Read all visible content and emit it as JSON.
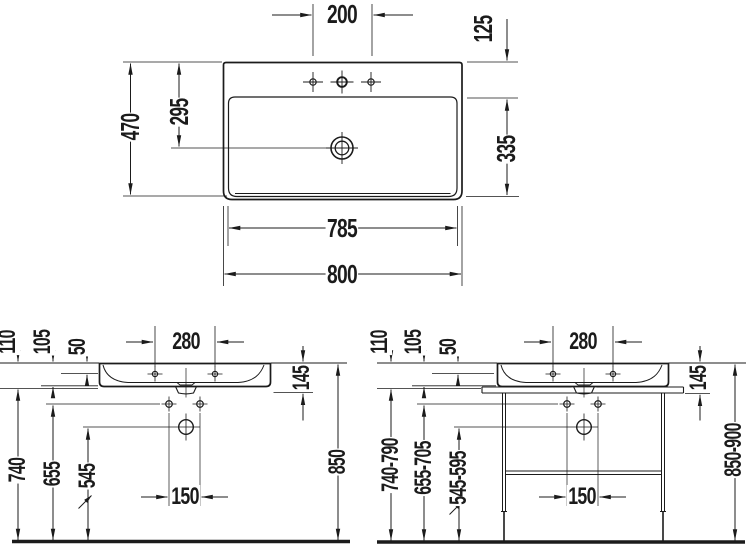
{
  "colors": {
    "line": "#1b1b1b",
    "background": "#ffffff"
  },
  "views": {
    "plan": {
      "faucet_hole_spacing": "200",
      "rear_ledge_depth": "125",
      "overall_depth": "470",
      "rear_to_drain": "295",
      "bowl_depth": "335",
      "lower_width": "785",
      "overall_width": "800"
    },
    "front_wall_mounted": {
      "deck_hole_spacing": "280",
      "rim_to_line_a": "110",
      "rim_to_line_b": "105",
      "rim_to_line_c": "50",
      "basin_height": "145",
      "rim_height": "850",
      "underside_height": "740",
      "fixing_holes_height": "655",
      "drain_height": "545",
      "fixing_hole_spacing": "150"
    },
    "front_with_console": {
      "deck_hole_spacing": "280",
      "rim_to_line_a": "110",
      "rim_to_line_b": "105",
      "rim_to_line_c": "50",
      "basin_height": "145",
      "rim_height": "850-900",
      "underside_height": "740-790",
      "fixing_holes_height": "655-705",
      "drain_height": "545-595",
      "fixing_hole_spacing": "150"
    }
  }
}
